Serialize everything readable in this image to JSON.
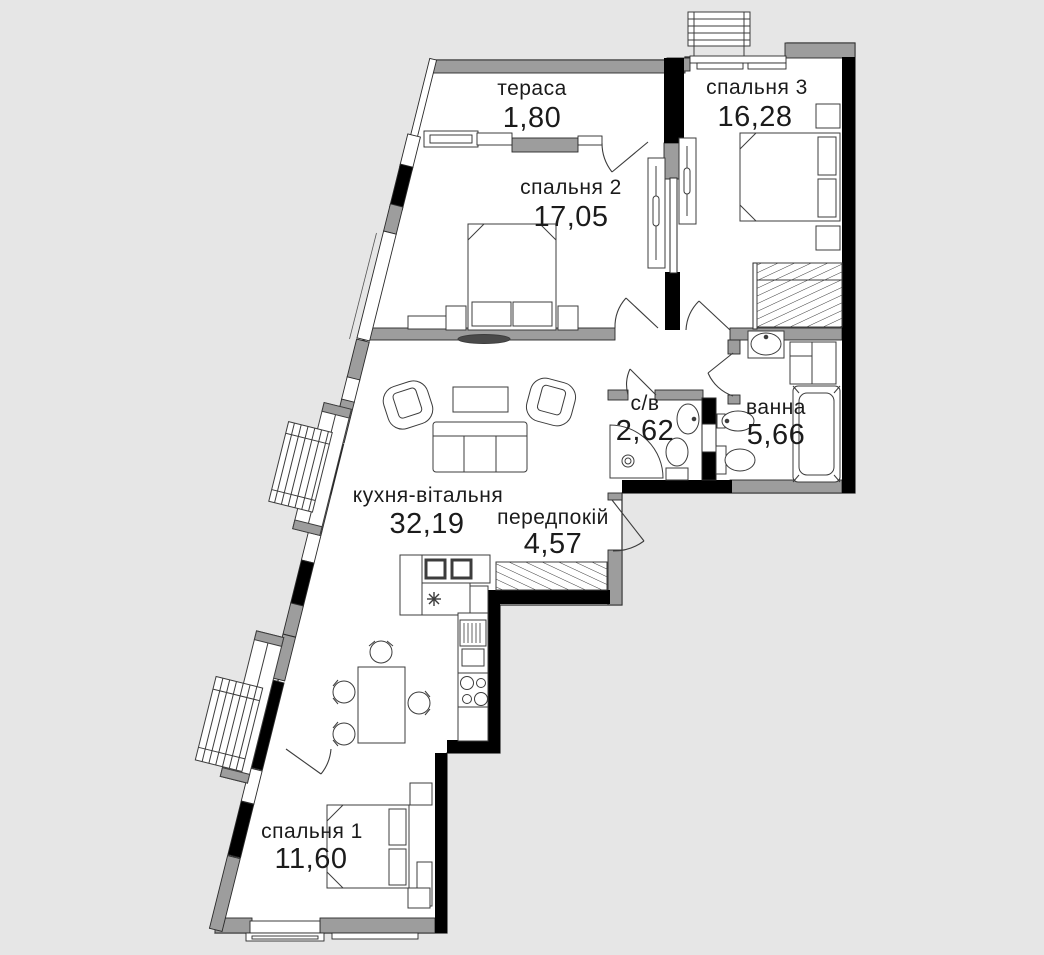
{
  "plan": {
    "colors": {
      "background": "#e6e6e6",
      "floor": "#ffffff",
      "wall": "#000000",
      "trim": "#9d9d9d",
      "furniture_line": "#3c3c3c",
      "text": "#1b1b1b"
    },
    "rooms": [
      {
        "key": "terrace",
        "name": "тераса",
        "area": "1,80"
      },
      {
        "key": "bedroom-3",
        "name": "спальня 3",
        "area": "16,28"
      },
      {
        "key": "bedroom-2",
        "name": "спальня 2",
        "area": "17,05"
      },
      {
        "key": "wc",
        "name": "с/в",
        "area": "2,62"
      },
      {
        "key": "bathroom",
        "name": "ванна",
        "area": "5,66"
      },
      {
        "key": "kitchen-living",
        "name": "кухня-вітальня",
        "area": "32,19"
      },
      {
        "key": "hallway",
        "name": "передпокій",
        "area": "4,57"
      },
      {
        "key": "bedroom-1",
        "name": "спальня 1",
        "area": "11,60"
      }
    ],
    "fixtures": [
      "double-bed",
      "nightstand",
      "wardrobe",
      "sofa",
      "armchair",
      "coffee-table",
      "dining-table",
      "chair",
      "kitchen-counter",
      "sink",
      "fridge",
      "oven",
      "stove",
      "shower",
      "toilet",
      "washbasin",
      "bidet",
      "bathtub",
      "ac-outdoor-unit",
      "balcony-glazing",
      "entrance-door"
    ]
  }
}
